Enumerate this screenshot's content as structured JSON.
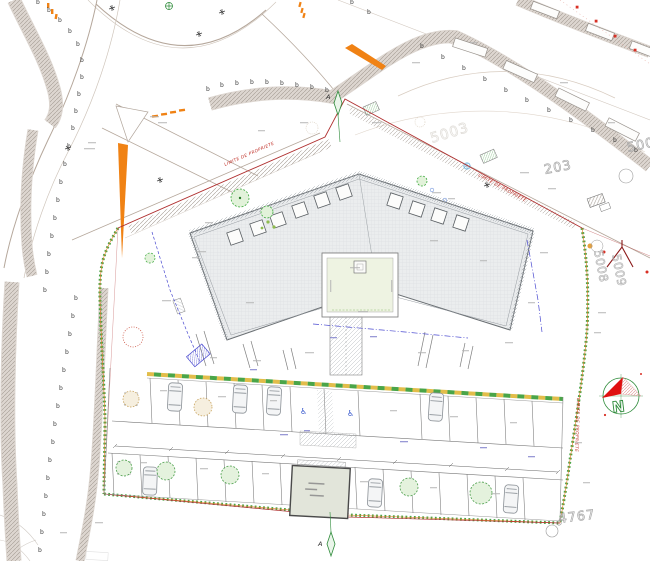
{
  "labels": {
    "property_line": "LIMITE DE PROPRIETE",
    "north": "N",
    "section_a": "A",
    "survey_mark": "b"
  },
  "parcels": {
    "p203": "203",
    "p5003": "5003",
    "p5008": "5008",
    "p5009": "5009",
    "p4767": "4767"
  },
  "colors": {
    "property_line_red": "#b03030",
    "accent_red": "#d93025",
    "hedge_green": "#4aa548",
    "hedge_yellow": "#e2bd4a",
    "highlight_orange": "#f08214",
    "north_arrow_red": "#e01010",
    "dashed_blue": "#4a4ad0",
    "road_gray": "#b5a79b",
    "parcel_number_gray": "#a8a8a8"
  }
}
